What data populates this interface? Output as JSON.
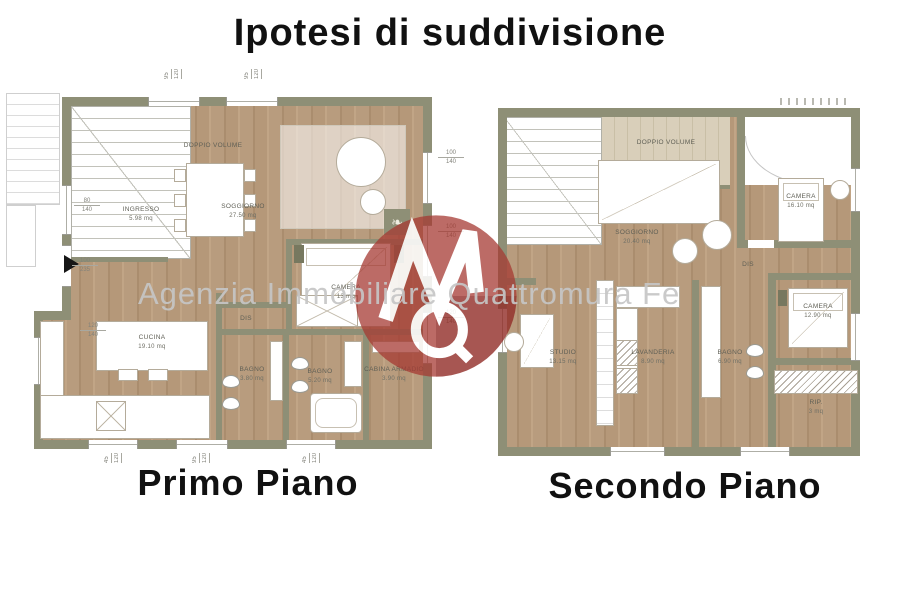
{
  "title": "Ipotesi di suddivisione",
  "watermark": {
    "agency_text": "Agenzia Immobiliare Quattromura Fe",
    "text_color": "#c6c6c6",
    "logo_color": "#a63a32"
  },
  "colors": {
    "wall": "#8e8f76",
    "floor_wood": "#b79b7c",
    "floor_light_wood": "#d8cdb6"
  },
  "icons": {
    "plant": "❧"
  },
  "plans": [
    {
      "label": "Primo Piano",
      "rooms": [
        {
          "name": "DOPPIO VOLUME",
          "area": ""
        },
        {
          "name": "INGRESSO",
          "area": "5.98 mq"
        },
        {
          "name": "SOGGIORNO",
          "area": "27.50 mq"
        },
        {
          "name": "CAMERA",
          "area": "13 mq"
        },
        {
          "name": "DIS",
          "area": ""
        },
        {
          "name": "CUCINA",
          "area": "19.10 mq"
        },
        {
          "name": "BAGNO",
          "area": "3.80 mq"
        },
        {
          "name": "BAGNO",
          "area": "5.20 mq"
        },
        {
          "name": "CABINA ARMADIO",
          "area": "3.90 mq"
        }
      ],
      "dims": {
        "right": [
          {
            "a": "100",
            "b": "140"
          },
          {
            "a": "100",
            "b": "140"
          },
          {
            "a": "120",
            "b": "140"
          }
        ],
        "left": [
          {
            "a": "80",
            "b": "140"
          },
          {
            "a": "100",
            "b": "235"
          },
          {
            "a": "120",
            "b": "140"
          }
        ],
        "top": [
          {
            "a": "95",
            "b": "120"
          },
          {
            "a": "95",
            "b": "120"
          }
        ],
        "bottom": [
          {
            "a": "45",
            "b": "120"
          },
          {
            "a": "95",
            "b": "120"
          },
          {
            "a": "45",
            "b": "120"
          }
        ]
      }
    },
    {
      "label": "Secondo Piano",
      "rooms": [
        {
          "name": "DOPPIO VOLUME",
          "area": ""
        },
        {
          "name": "SOGGIORNO",
          "area": "20.40 mq"
        },
        {
          "name": "CAMERA",
          "area": "16.10 mq"
        },
        {
          "name": "DIS",
          "area": ""
        },
        {
          "name": "STUDIO",
          "area": "13.15 mq"
        },
        {
          "name": "LAVANDERIA",
          "area": "8.90 mq"
        },
        {
          "name": "BAGNO",
          "area": "6.90 mq"
        },
        {
          "name": "CAMERA",
          "area": "12.90 mq"
        },
        {
          "name": "RIP.",
          "area": "3 mq"
        }
      ]
    }
  ]
}
